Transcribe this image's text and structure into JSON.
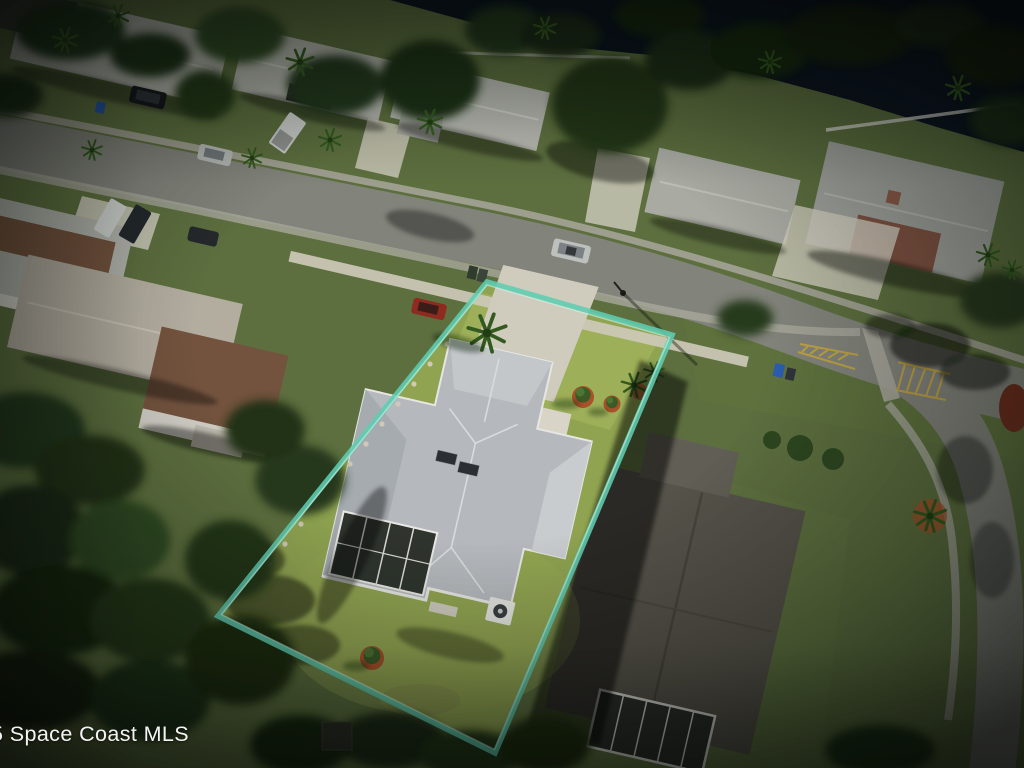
{
  "watermark": {
    "text": "5 Space Coast MLS"
  },
  "colors": {
    "boundary": "#5ecdb2",
    "boundary_highlight": "#d8f5ea",
    "subject_lawn": "#8fa351",
    "subject_lawn_bright": "#a3b45c",
    "base_ground": "#5d6f3f",
    "road": "#82837b",
    "sidewalk": "#a8a79c",
    "concrete": "#cfccbe",
    "roof_subject": "#b5b9bd",
    "roof_light": "#b2b4ab",
    "roof_brown": "#73533e",
    "roof_neighbor_dark": "#56534a",
    "water": "#0c1520",
    "tree": "#24371a",
    "tree_light": "#2f4a20",
    "mulch": "#a8512a",
    "marking_yellow": "#c9a83c",
    "watermark": "#ffffff"
  }
}
